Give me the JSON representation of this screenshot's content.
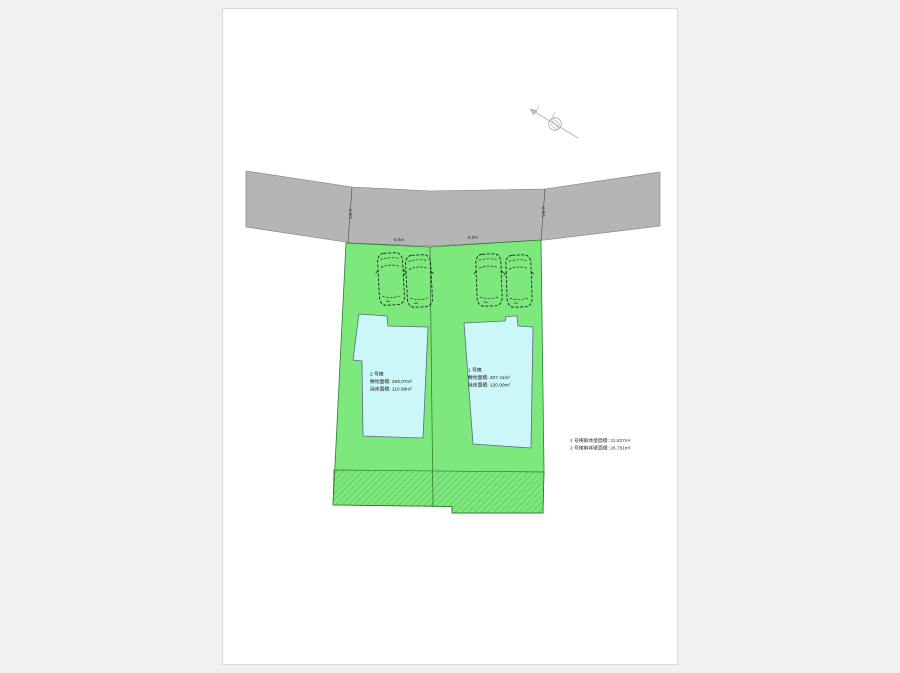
{
  "plan": {
    "dimensions": {
      "frontage_left": "8.8m",
      "frontage_right": "8.9m",
      "side_left": "6.0m",
      "side_right": "6.0m"
    },
    "lot2": {
      "name": "2 号棟",
      "site_area": "敷地面積: 200.07m²",
      "floor_area": "延床面積: 110.98m²"
    },
    "lot1": {
      "name": "1 号棟",
      "site_area": "敷地面積: 207.41m²",
      "floor_area": "延床面積: 120.90m²"
    },
    "notes": [
      "1 号棟解体壁面積: 31.827m²",
      "2 号棟解体壁面積: 26.761m²"
    ],
    "colors": {
      "road_gray": "#b5b5b5",
      "plot_green": "#7de97d",
      "building_cyan": "#ccf7f9",
      "hatch_green": "#3d8f3d"
    }
  }
}
